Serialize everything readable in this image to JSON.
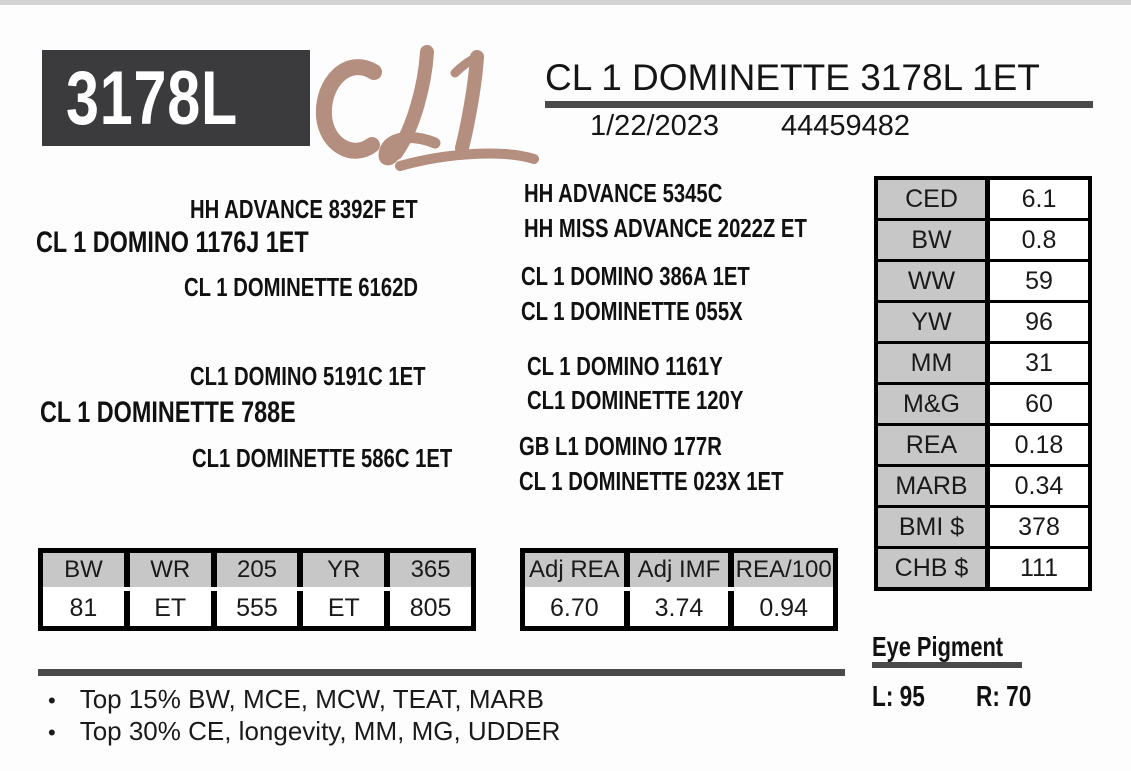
{
  "header": {
    "tag_number": "3178L",
    "brand": "CL1",
    "animal_name": "CL 1 DOMINETTE 3178L 1ET",
    "birth_date": "1/22/2023",
    "registration_number": "44459482"
  },
  "pedigree": {
    "sire_group": {
      "grandsire": "HH ADVANCE 8392F ET",
      "sire": "CL 1 DOMINO 1176J 1ET",
      "granddam": "CL 1 DOMINETTE 6162D"
    },
    "dam_group": {
      "grandsire": "CL1 DOMINO 5191C 1ET",
      "dam": "CL 1 DOMINETTE 788E",
      "granddam": "CL1 DOMINETTE 586C 1ET"
    },
    "great_grandparents": [
      "HH ADVANCE 5345C",
      "HH MISS ADVANCE 2022Z ET",
      "CL 1 DOMINO 386A 1ET",
      "CL 1 DOMINETTE 055X",
      "CL 1 DOMINO 1161Y",
      "CL1 DOMINETTE 120Y",
      "GB L1 DOMINO 177R",
      "CL 1 DOMINETTE 023X 1ET"
    ]
  },
  "epd_table": {
    "rows": [
      {
        "label": "CED",
        "value": "6.1"
      },
      {
        "label": "BW",
        "value": "0.8"
      },
      {
        "label": "WW",
        "value": "59"
      },
      {
        "label": "YW",
        "value": "96"
      },
      {
        "label": "MM",
        "value": "31"
      },
      {
        "label": "M&G",
        "value": "60"
      },
      {
        "label": "REA",
        "value": "0.18"
      },
      {
        "label": "MARB",
        "value": "0.34"
      },
      {
        "label": "BMI $",
        "value": "378"
      },
      {
        "label": "CHB $",
        "value": "111"
      }
    ]
  },
  "performance_table": {
    "headers": [
      "BW",
      "WR",
      "205",
      "YR",
      "365"
    ],
    "values": [
      "81",
      "ET",
      "555",
      "ET",
      "805"
    ]
  },
  "carcass_table": {
    "headers": [
      "Adj REA",
      "Adj IMF",
      "REA/100"
    ],
    "values": [
      "6.70",
      "3.74",
      "0.94"
    ]
  },
  "eye_pigment": {
    "title": "Eye Pigment",
    "left": "L: 95",
    "right": "R: 70"
  },
  "notes": [
    "Top 15% BW, MCE, MCW, TEAT, MARB",
    "Top 30% CE, longevity, MM, MG, UDDER"
  ],
  "bullet_glyph": "•",
  "colors": {
    "tag_box_dark": "#3b3b3e",
    "rule_dark": "#4a4a4a",
    "brand_tan": "#b48e7e",
    "table_header_gray": "#c7c7c7",
    "table_border_black": "#000000"
  }
}
